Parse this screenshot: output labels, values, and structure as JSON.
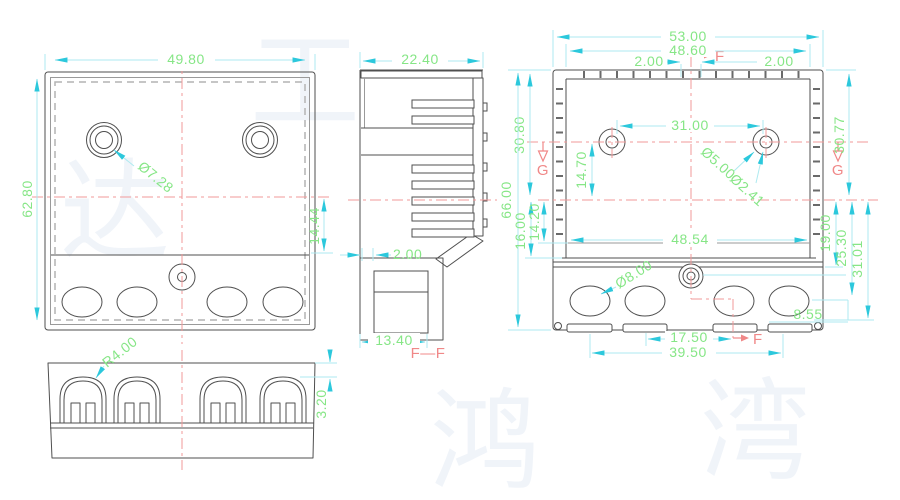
{
  "watermark": {
    "chars": [
      "达",
      "鸿",
      "湾",
      "工"
    ]
  },
  "views": {
    "front": {
      "dims": {
        "width": "49.80",
        "height": "62.80",
        "hole_dia": "Ø7.28",
        "lower_offset": "14.44"
      }
    },
    "bottom": {
      "dims": {
        "corner_radius": "R4.00",
        "step_height": "3.20"
      }
    },
    "section_ff": {
      "label": "F—F",
      "dims": {
        "width": "22.40",
        "wall_thickness": "2.00",
        "foot_width": "13.40"
      }
    },
    "back": {
      "dims": {
        "overall_width": "53.00",
        "inner_width": "48.60",
        "tab_left": "2.00",
        "tab_right": "2.00",
        "hole_spacing": "31.00",
        "depth_left": "30.80",
        "depth_right": "30.77",
        "hole_drop": "14.70",
        "boss_dia": "Ø5.00",
        "pilot_dia": "Ø2.41",
        "overall_height": "66.00",
        "cavity_depth": "16.00",
        "recess_depth": "14.20",
        "cavity_width": "48.54",
        "drop_a": "19.00",
        "drop_b": "25.30",
        "drop_c": "31.01",
        "knockout_dia": "Ø8.00",
        "slot_edge": "8.55",
        "slot_pitch": "17.50",
        "slot_span": "39.50"
      },
      "markers": {
        "f_top": "F",
        "f_bottom": "F",
        "g_left": "G",
        "g_right": "G"
      }
    }
  },
  "colors": {
    "outline": "#4f4f4f",
    "dim_line": "#aeeaf0",
    "dim_arrow": "#2cc8dc",
    "dim_text": "#86e686",
    "centerline": "#f29a9a",
    "section_label": "#f08888",
    "hatch": "#e6a8e6",
    "background": "#ffffff"
  }
}
